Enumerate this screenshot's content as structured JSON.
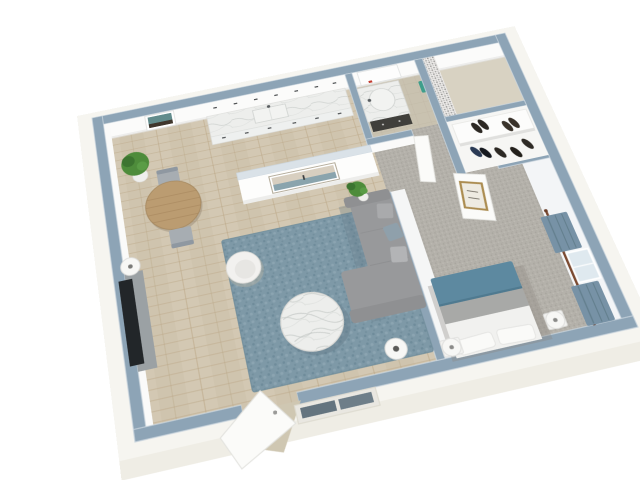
{
  "scene": {
    "title": "One-bedroom apartment 3D floor plan",
    "description": "Isometric 3D architectural rendering of a one-bedroom apartment: open kitchen with marble counter, dining nook, living room with sofa and blue rug, bathroom with dark vanity and mosaic shower, walk-in shoe closet, and bedroom with teal bed and curtained window; open entry door at the front wall",
    "view": "3D dollhouse cutaway, walls capped in blue-gray",
    "rooms": [
      {
        "name": "Kitchen",
        "floor": "light oak plank",
        "features": [
          "marble counter",
          "white cabinets with dark handles",
          "sink with faucet"
        ]
      },
      {
        "name": "Dining Area",
        "floor": "light oak plank",
        "features": [
          "round wood table",
          "two gray chairs",
          "potted plant",
          "framed wall art"
        ]
      },
      {
        "name": "Living Room",
        "floor": "light oak plank",
        "features": [
          "gray sectional sofa with pillows",
          "blue area rug",
          "round marble coffee table",
          "white barrel armchair",
          "TV on gray console",
          "floor lamp",
          "table lamp",
          "potted plant",
          "seascape art on half wall",
          "open entry door"
        ]
      },
      {
        "name": "Bathroom",
        "floor": "beige tile",
        "features": [
          "dark vanity with marble top",
          "mirror",
          "teal towel",
          "mosaic tile shower wall",
          "open bathroom door"
        ]
      },
      {
        "name": "Closet",
        "floor": "carpet",
        "features": [
          "white shoe shelves",
          "several pairs of shoes"
        ]
      },
      {
        "name": "Bedroom",
        "floor": "gray carpet",
        "features": [
          "bed with teal blanket, gray band and white sheets",
          "two pillows",
          "two nightstands with round white lamps",
          "window with blue-gray curtains and wood rod",
          "door with gold-framed art"
        ]
      }
    ],
    "palette": {
      "background": "#ffffff",
      "wallTop": "#8da4b6",
      "wallTopLight": "#dae2e8",
      "wallEdge": "#cdd8e0",
      "wallFace": "#fbfbfa",
      "wallFaceEast": "#f3f5f7",
      "skirt": "#f6f5f0",
      "skirtShade": "#ece9e1",
      "woodFloor": "#d3c8b3",
      "carpet": "#b4b1aa",
      "bathTile": "#c9c2b0",
      "showerTile": "#d8d2c2",
      "rug": "#7e99a7",
      "shadowBlue": "#5f7683",
      "sofa": "#98999b",
      "sofaArm": "#8f9092",
      "pillowGray": "#a9aaac",
      "pillowLight": "#b3b4b6",
      "pillowBlue": "#8fa0ab",
      "marble": "#edeeec",
      "armchair": "#f2f1ef",
      "armchairSeat": "#e7e6e3",
      "tv": "#222629",
      "console": "#9ba1a4",
      "lampWhite": "#f7f7f5",
      "lampCore": "#5a5a58",
      "bedTeal": "#5d89a0",
      "bedGray": "#a8a9a7",
      "bedSheet": "#f1f1ef",
      "pillowWhite": "#fafaf8",
      "nightstand": "#f2f2f0",
      "curtain": "#7792a6",
      "curtainFold": "#64808f",
      "rod": "#7b4a31",
      "glass": "#dfe9ef",
      "vanityDark": "#403f3b",
      "basin": "#f2f3f1",
      "towel": "#3f9e8b",
      "mirror": "#fdfdfd",
      "redAccent": "#c23b2e",
      "plantGreen": "#4e8c3b",
      "plantDark": "#3c7430",
      "pot": "#efefed",
      "tableWood": "#bb9c71",
      "chairGray": "#a7adb2",
      "chairBack": "#8f98a1",
      "door": "#fbfbf9",
      "doorTan": "#cfc7b2",
      "artGoldFrame": "#ab8c50",
      "artPaper": "#eeebe2",
      "seaSky": "#d8cfc0",
      "seaWater": "#8aa4ad",
      "artTeal": "#628c8c",
      "artDark": "#3f362c",
      "shoeDark": "#2c2823",
      "shoeNavy": "#2a3a55",
      "paneDark": "#64747f",
      "shelfWhite": "#fcfcfb"
    }
  }
}
